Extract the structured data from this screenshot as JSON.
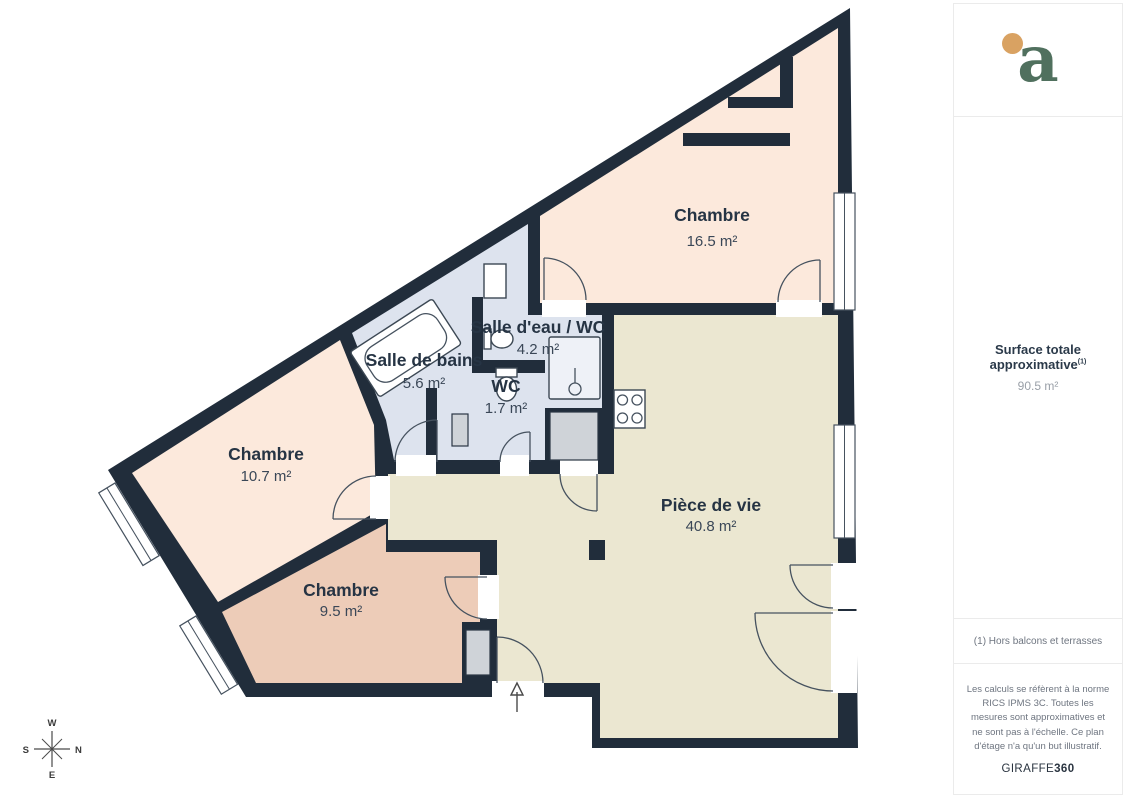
{
  "floor_plan": {
    "rooms": [
      {
        "name": "Chambre",
        "area": "16.5 m²"
      },
      {
        "name": "Salle d'eau / WC",
        "area": "4.2 m²"
      },
      {
        "name": "Salle de bains",
        "area": "5.6 m²"
      },
      {
        "name": "WC",
        "area": "1.7 m²"
      },
      {
        "name": "Chambre",
        "area": "10.7 m²"
      },
      {
        "name": "Chambre",
        "area": "9.5 m²"
      },
      {
        "name": "Pièce de vie",
        "area": "40.8 m²"
      }
    ],
    "compass": {
      "top": "W",
      "right": "N",
      "left": "S",
      "bottom": "E"
    },
    "colors": {
      "wall": "#212d3b",
      "bedroom_peach": "#fce9dc",
      "bedroom_tan": "#edccb8",
      "living_cream": "#ebe7d1",
      "bathroom_blue": "#dde3ee"
    }
  },
  "sidebar": {
    "logo_letter": "a",
    "surface_title": "Surface totale approximative",
    "surface_title_sup": "(1)",
    "surface_value": "90.5 m²",
    "footnote": "(1) Hors balcons et terrasses",
    "disclaimer": "Les calculs se réfèrent à la norme RICS IPMS 3C. Toutes les mesures sont approximatives et ne sont pas à l'échelle. Ce plan d'étage n'a qu'un but illustratif.",
    "brand": "GIRAFFE",
    "brand_suffix": "360"
  }
}
